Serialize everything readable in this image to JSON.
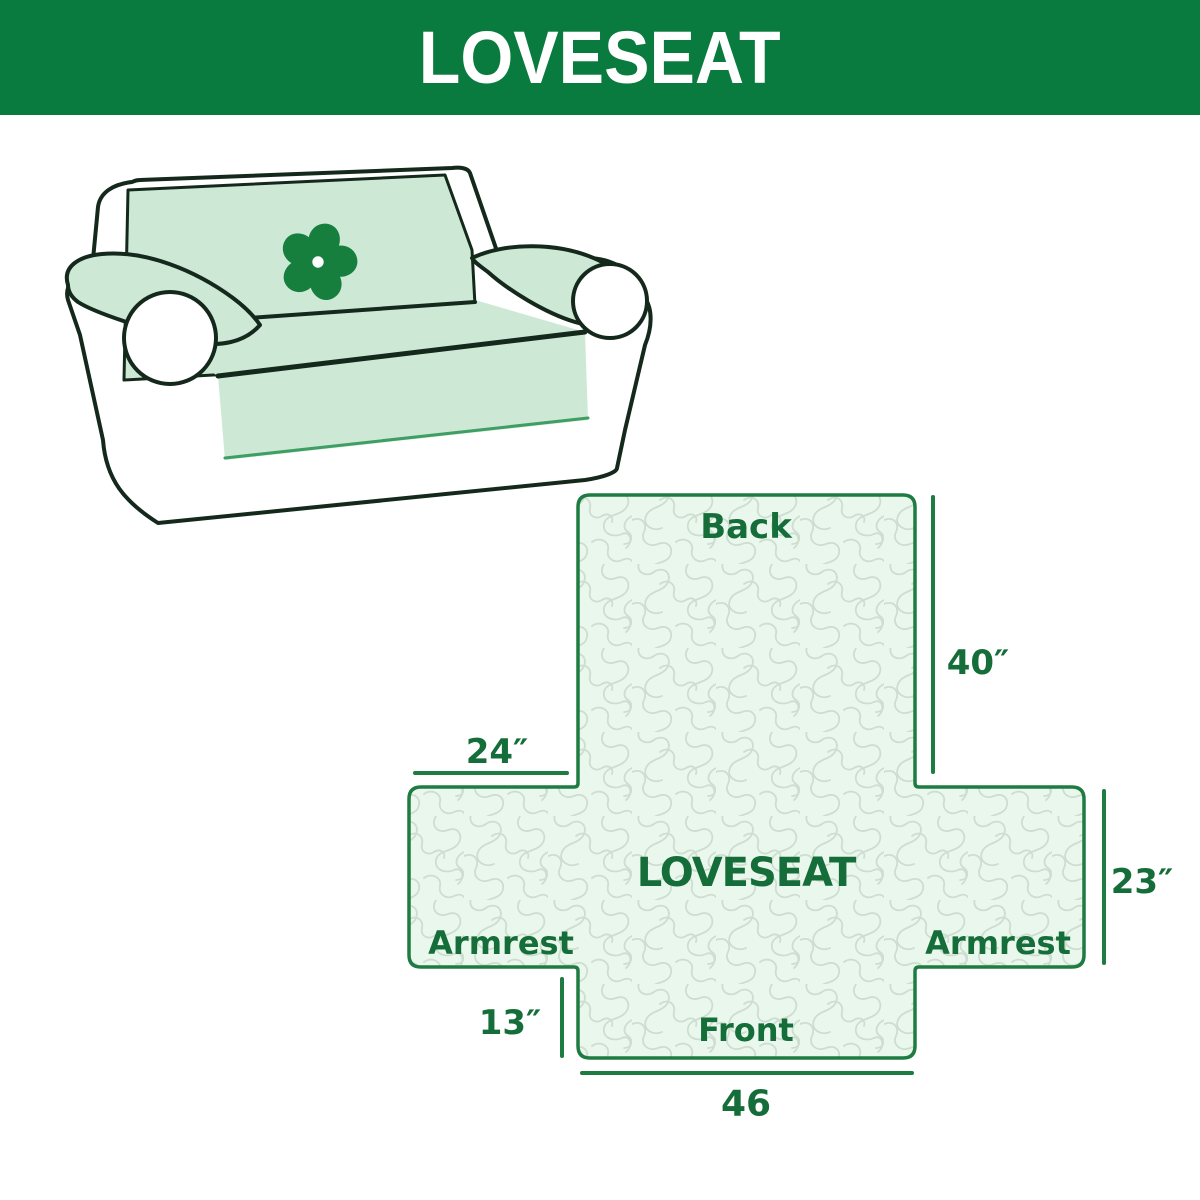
{
  "header": {
    "title": "LOVESEAT"
  },
  "illustration": {
    "logo_icon": "pinwheel-icon",
    "subject": "loveseat sofa with slipcover"
  },
  "diagram": {
    "center_label": "LOVESEAT",
    "back_label": "Back",
    "front_label": "Front",
    "armrest_left_label": "Armrest",
    "armrest_right_label": "Armrest",
    "dims": {
      "back_height": "40″",
      "armrest_width": "24″",
      "armrest_height": "23″",
      "front_drop": "13″",
      "front_width": "46"
    }
  },
  "colors": {
    "header_bg": "#0a7b3e",
    "header_text": "#ffffff",
    "sofa_outline": "#14291c",
    "cover_mint": "#cde9d6",
    "logo_green": "#177f3e",
    "diagram_fill": "#eaf7ed",
    "diagram_outline": "#1e7b41",
    "diagram_text": "#156e39",
    "pattern_line": "#cdddcf",
    "skirt_edge": "#3f9e63"
  }
}
